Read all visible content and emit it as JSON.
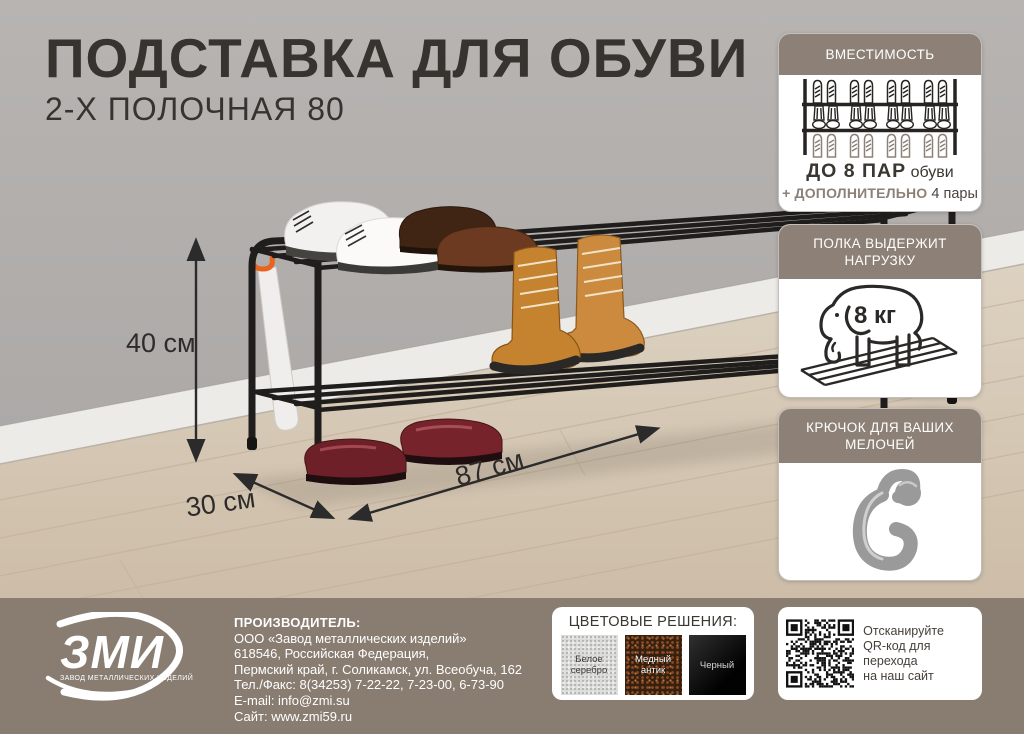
{
  "title": "ПОДСТАВКА ДЛЯ ОБУВИ",
  "subtitle": "2-Х ПОЛОЧНАЯ 80",
  "dimensions": {
    "height": "40 см",
    "depth": "30 см",
    "width": "87 см"
  },
  "cards": {
    "capacity": {
      "header": "ВМЕСТИМОСТЬ",
      "count_bold": "ДО 8 ПАР",
      "count_rest": " обуви",
      "extra_bold": "+ ДОПОЛНИТЕЛЬНО",
      "extra_rest": " 4 пары"
    },
    "load": {
      "header_lines": [
        "ПОЛКА ВЫДЕРЖИТ",
        "НАГРУЗКУ"
      ],
      "value": "8 кг"
    },
    "hook": {
      "header_lines": [
        "КРЮЧОК ДЛЯ ВАШИХ",
        "МЕЛОЧЕЙ"
      ]
    }
  },
  "footer": {
    "logo": {
      "name": "ЗМИ",
      "tagline": "ЗАВОД МЕТАЛЛИЧЕСКИХ ИЗДЕЛИЙ"
    },
    "manufacturer": {
      "label": "ПРОИЗВОДИТЕЛЬ:",
      "lines": [
        "ООО «Завод металлических изделий»",
        "618546, Российская Федерация,",
        "Пермский край, г. Соликамск, ул. Всеобуча, 162",
        "Тел./Факс: 8(34253) 7-22-22, 7-23-00, 6-73-90",
        "E-mail: info@zmi.su",
        "Сайт: www.zmi59.ru"
      ]
    },
    "colors": {
      "title": "ЦВЕТОВЫЕ РЕШЕНИЯ:",
      "swatches": [
        {
          "lines": [
            "Белое",
            "серебро"
          ]
        },
        {
          "lines": [
            "Медный",
            "антик"
          ]
        },
        {
          "lines": [
            "Черный"
          ]
        }
      ]
    },
    "qr": {
      "lines": [
        "Отсканируйте",
        "QR-код для перехода",
        "на наш сайт"
      ]
    }
  },
  "palette": {
    "accent_taupe": "#8d8177",
    "footer_bg": "#897d72",
    "wall_gray": "#b2afad",
    "floor_beige": "#d8cbba",
    "hook_orange": "#e8641f"
  }
}
